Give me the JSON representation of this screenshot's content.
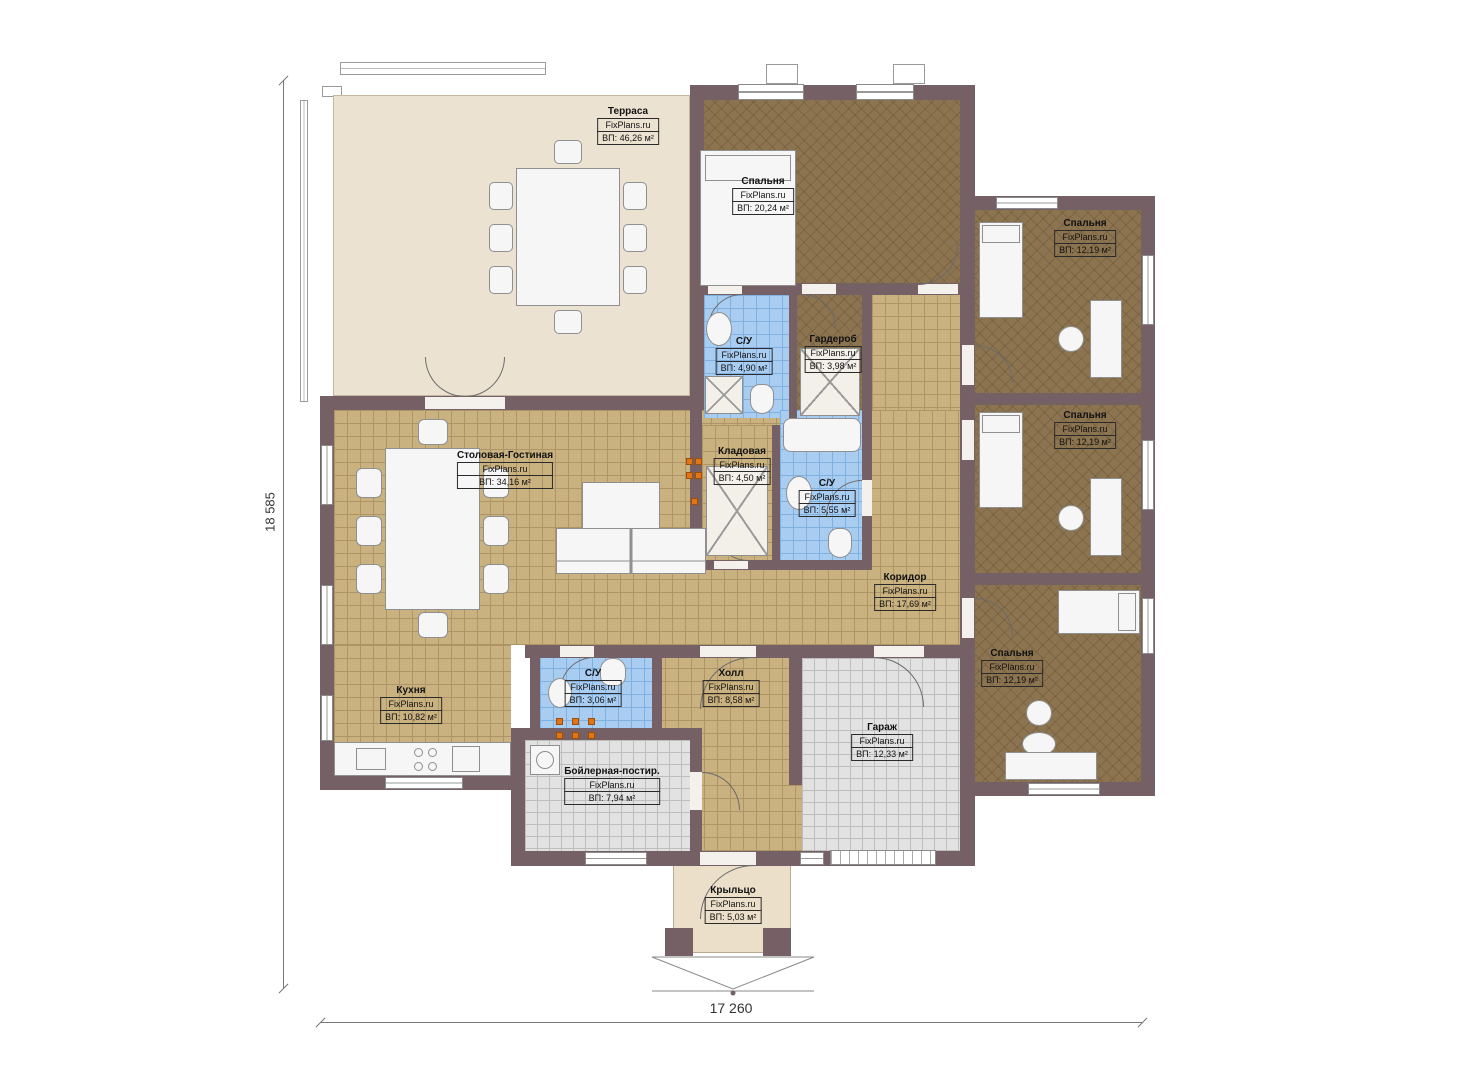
{
  "plan": {
    "site": "FixPlans.ru",
    "rooms": [
      {
        "id": "terrace",
        "name": "Терраса",
        "area": "ВП: 46,26 м²"
      },
      {
        "id": "bedroom-master",
        "name": "Спальня",
        "area": "ВП: 20,24 м²"
      },
      {
        "id": "bedroom-top-right",
        "name": "Спальня",
        "area": "ВП: 12,19 м²"
      },
      {
        "id": "bedroom-mid-right",
        "name": "Спальня",
        "area": "ВП: 12,19 м²"
      },
      {
        "id": "bedroom-bottom-right",
        "name": "Спальня",
        "area": "ВП: 12,19 м²"
      },
      {
        "id": "bathroom-1",
        "name": "С/У",
        "area": "ВП: 4,90 м²"
      },
      {
        "id": "wardrobe",
        "name": "Гардероб",
        "area": "ВП: 3,98 м²"
      },
      {
        "id": "pantry",
        "name": "Кладовая",
        "area": "ВП: 4,50 м²"
      },
      {
        "id": "bathroom-2",
        "name": "С/У",
        "area": "ВП: 5,55 м²"
      },
      {
        "id": "living-dining",
        "name": "Столовая-Гостиная",
        "area": "ВП: 34,16 м²"
      },
      {
        "id": "corridor",
        "name": "Коридор",
        "area": "ВП: 17,69 м²"
      },
      {
        "id": "kitchen",
        "name": "Кухня",
        "area": "ВП: 10,82 м²"
      },
      {
        "id": "bathroom-3",
        "name": "С/У",
        "area": "ВП: 3,06 м²"
      },
      {
        "id": "hall",
        "name": "Холл",
        "area": "ВП: 8,58 м²"
      },
      {
        "id": "garage",
        "name": "Гараж",
        "area": "ВП: 12,33 м²"
      },
      {
        "id": "boiler-laundry",
        "name": "Бойлерная-постир.",
        "area": "ВП: 7,94 м²"
      },
      {
        "id": "porch",
        "name": "Крыльцо",
        "area": "ВП: 5,03 м²"
      }
    ],
    "dimensions": {
      "height": "18 585",
      "width": "17 260"
    },
    "colors": {
      "wall": "#756066",
      "floor_tile": "#c9b180",
      "bedroom_floor": "#8c7450",
      "bathroom_tile": "#a9cdf1",
      "utility_tile": "#e2e2e2",
      "terrace_floor": "#ece2d1",
      "stove_accent": "#e07518"
    }
  }
}
